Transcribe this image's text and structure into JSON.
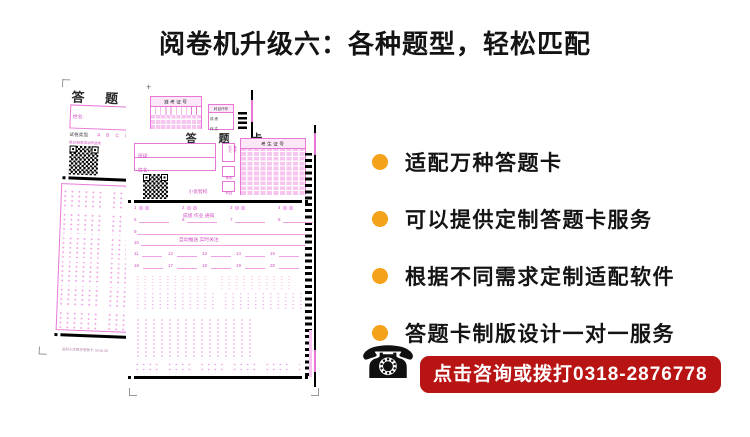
{
  "page": {
    "title": "阅卷机升级六：各种题型，轻松匹配"
  },
  "features": [
    {
      "label": "适配万种答题卡"
    },
    {
      "label": "可以提供定制答题卡服务"
    },
    {
      "label": "根据不同需求定制适配软件"
    },
    {
      "label": "答题卡制版设计一对一服务"
    }
  ],
  "contact": {
    "phone_glyph": "☎",
    "cta_label": "点击咨询或拨打0318-2876778"
  },
  "colors": {
    "accent-orange": "#f5a21b",
    "cta-red": "#b81414",
    "ink": "#141414",
    "pink": "#e878d8",
    "pink-fill": "#f7c4ef",
    "pink-dot": "#f0a2e6",
    "pink-text": "#d050c0"
  },
  "back_sheet": {
    "title": "答 题 卡",
    "name_label": "姓名:",
    "type_label": "试卷类型",
    "type_options": "A B C D",
    "fill_note": "用2B铅笔填涂所选项",
    "qr_line1": "小优智校",
    "qr_line2": "成绩分析自动推送",
    "footer": "品科小优智校答题卡: 6018-28"
  },
  "front_sheet": {
    "plus_mark": "+",
    "title": "答 题 卡",
    "exam_no_header": "准 考 证 号",
    "subject_code_header": "科目代号",
    "subject_row1": "成 绩",
    "subject_row2": "作 文",
    "class_label": "班级:",
    "name_label": "姓名:",
    "absent_label": "缺考标记",
    "barcode_label": "条码",
    "subject_label": "科目",
    "candidate_no_header": "考 生 证 号",
    "qr_line1": "小优智校",
    "qr_line2": "成绩 作业 通知",
    "qr_line3": "自动推送 实时关注",
    "q_pair": [
      "1",
      "2",
      "3",
      "4"
    ],
    "q_blank": [
      "5",
      "6",
      "7",
      "8"
    ],
    "q_long1": "9",
    "q_long2": "10",
    "q_row5": [
      "11",
      "12",
      "13",
      "14",
      "15"
    ],
    "q_row6": [
      "16",
      "17",
      "18",
      "19",
      "20"
    ]
  }
}
